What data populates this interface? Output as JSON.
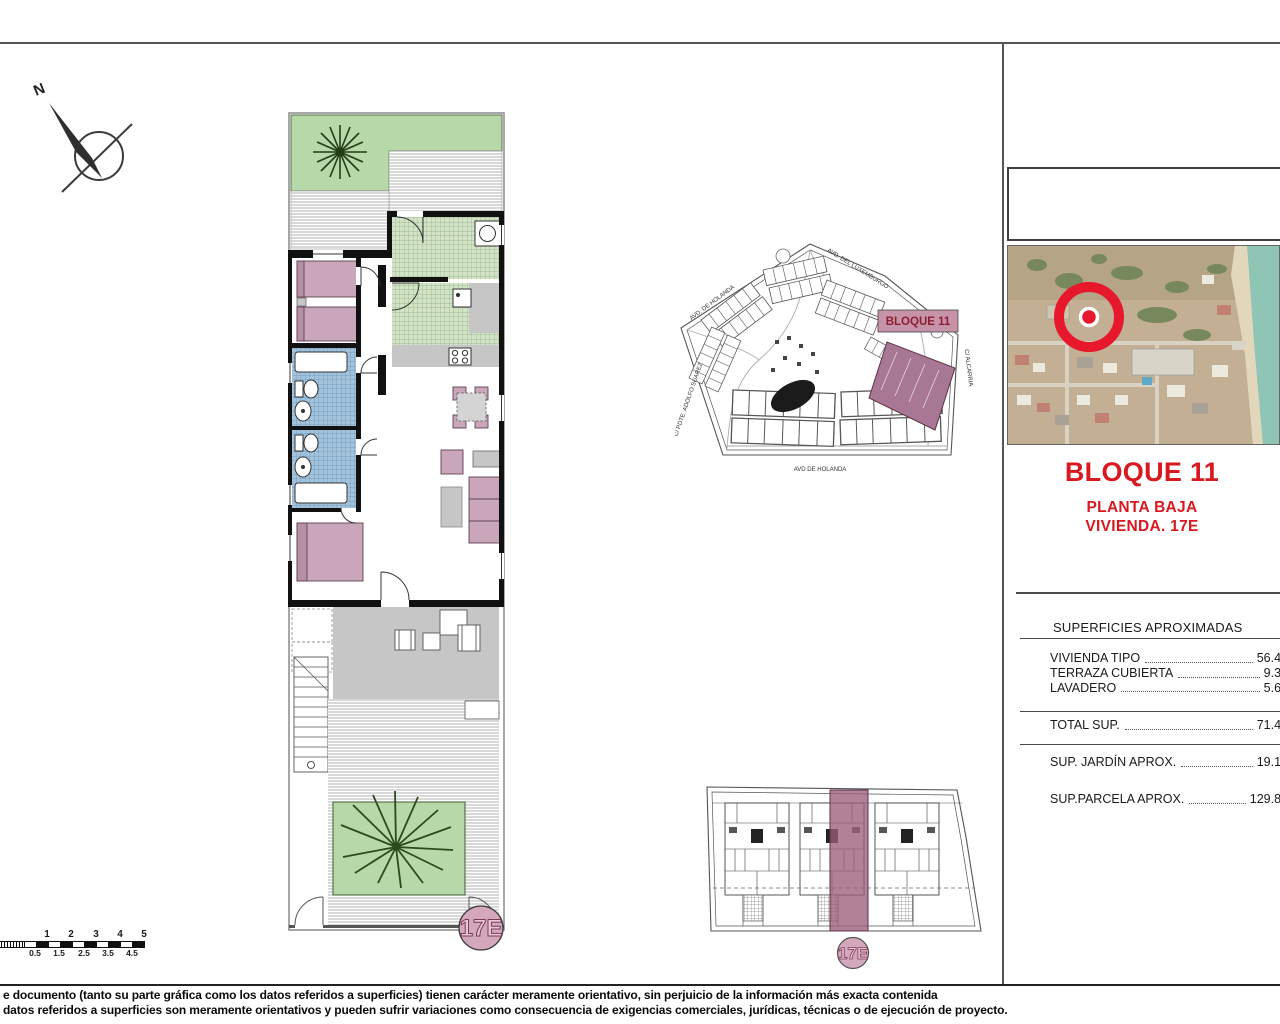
{
  "titles": {
    "block": "BLOQUE 11",
    "floor": "PLANTA BAJA",
    "unit": "VIVIENDA. 17E"
  },
  "surfaces": {
    "header": "SUPERFICIES APROXIMADAS",
    "rows": [
      {
        "label": "VIVIENDA TIPO",
        "value": "56.43"
      },
      {
        "label": "TERRAZA CUBIERTA",
        "value": "9.38"
      },
      {
        "label": "LAVADERO",
        "value": "5.62"
      }
    ],
    "total": {
      "label": "TOTAL SUP.",
      "value": "71.43"
    },
    "extras": [
      {
        "label": "SUP. JARDÍN APROX.",
        "value": "19.13"
      },
      {
        "label": "SUP.PARCELA APROX.",
        "value": "129.80"
      }
    ]
  },
  "site_plan": {
    "block_label": "BLOQUE 11",
    "streets": [
      "AVD. DE HOLANDA",
      "AVD. DEL LUXEMBURGO",
      "C/ ALCARRIA",
      "AVD DE HOLANDA",
      "C/ PDTE. ADOLFO SUAREZ"
    ]
  },
  "unit_badge": "17E",
  "compass_label": "N",
  "scale_bar": {
    "top": [
      "1",
      "2",
      "3",
      "4",
      "5"
    ],
    "bottom": [
      "0.5",
      "1.5",
      "2.5",
      "3.5",
      "4.5"
    ]
  },
  "footer": {
    "line1": "e documento (tanto su parte gráfica como los datos referidos a superficies) tienen carácter meramente orientativo, sin perjuicio de la información más exacta contenida",
    "line2": "datos referidos a superficies son meramente orientativos y pueden sufrir variaciones como consecuencia de exigencias comerciales, jurídicas, técnicas o de ejecución de proyecto."
  },
  "colors": {
    "accent_red": "#d8191f",
    "highlight_mauve": "#a87793",
    "badge_pink": "#d4a8bc"
  }
}
